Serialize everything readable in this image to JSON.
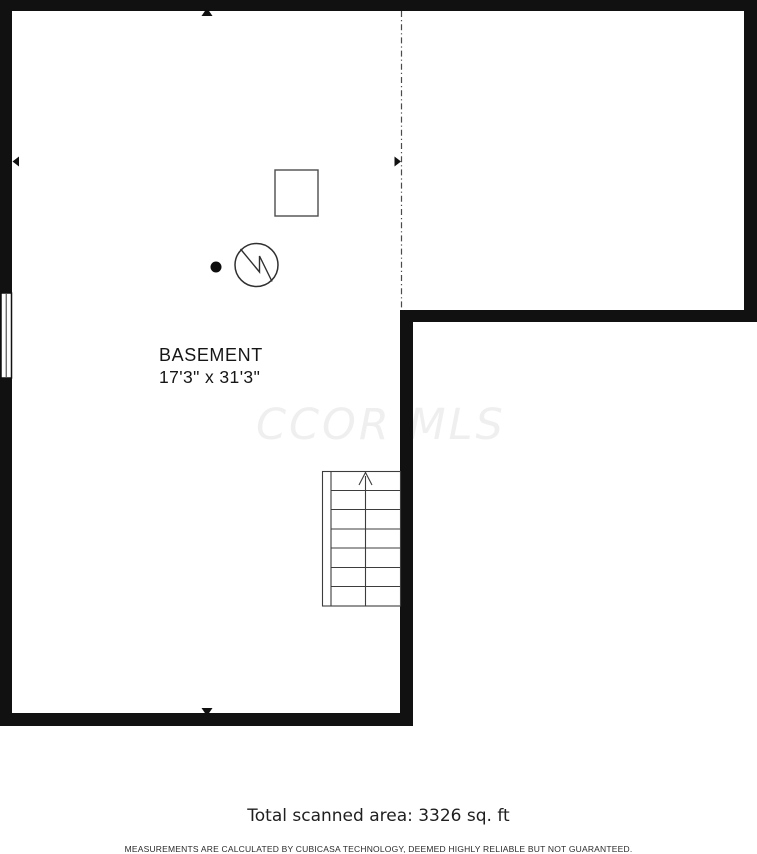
{
  "plan": {
    "room_label": "BASEMENT",
    "room_dimensions": "17'3\" x 31'3\"",
    "watermark": "CCOR MLS"
  },
  "footer": {
    "total_area": "Total scanned area: 3326 sq. ft",
    "disclaimer": "MEASUREMENTS ARE CALCULATED BY CUBICASA TECHNOLOGY, DEEMED HIGHLY RELIABLE BUT NOT GUARANTEED."
  },
  "colors": {
    "wall": "#111111",
    "symbol_stroke": "#3c3c3c",
    "watermark": "#efefef",
    "text": "#161616"
  },
  "icons": {
    "furnace": "furnace-square-icon",
    "water_heater": "water-heater-circle-icon",
    "point_marker": "scan-point-dot",
    "stairs": "staircase-up",
    "window": "window-symbol",
    "arrows": [
      "arrow-up-icon",
      "arrow-down-icon",
      "arrow-left-icon",
      "arrow-right-icon"
    ]
  }
}
